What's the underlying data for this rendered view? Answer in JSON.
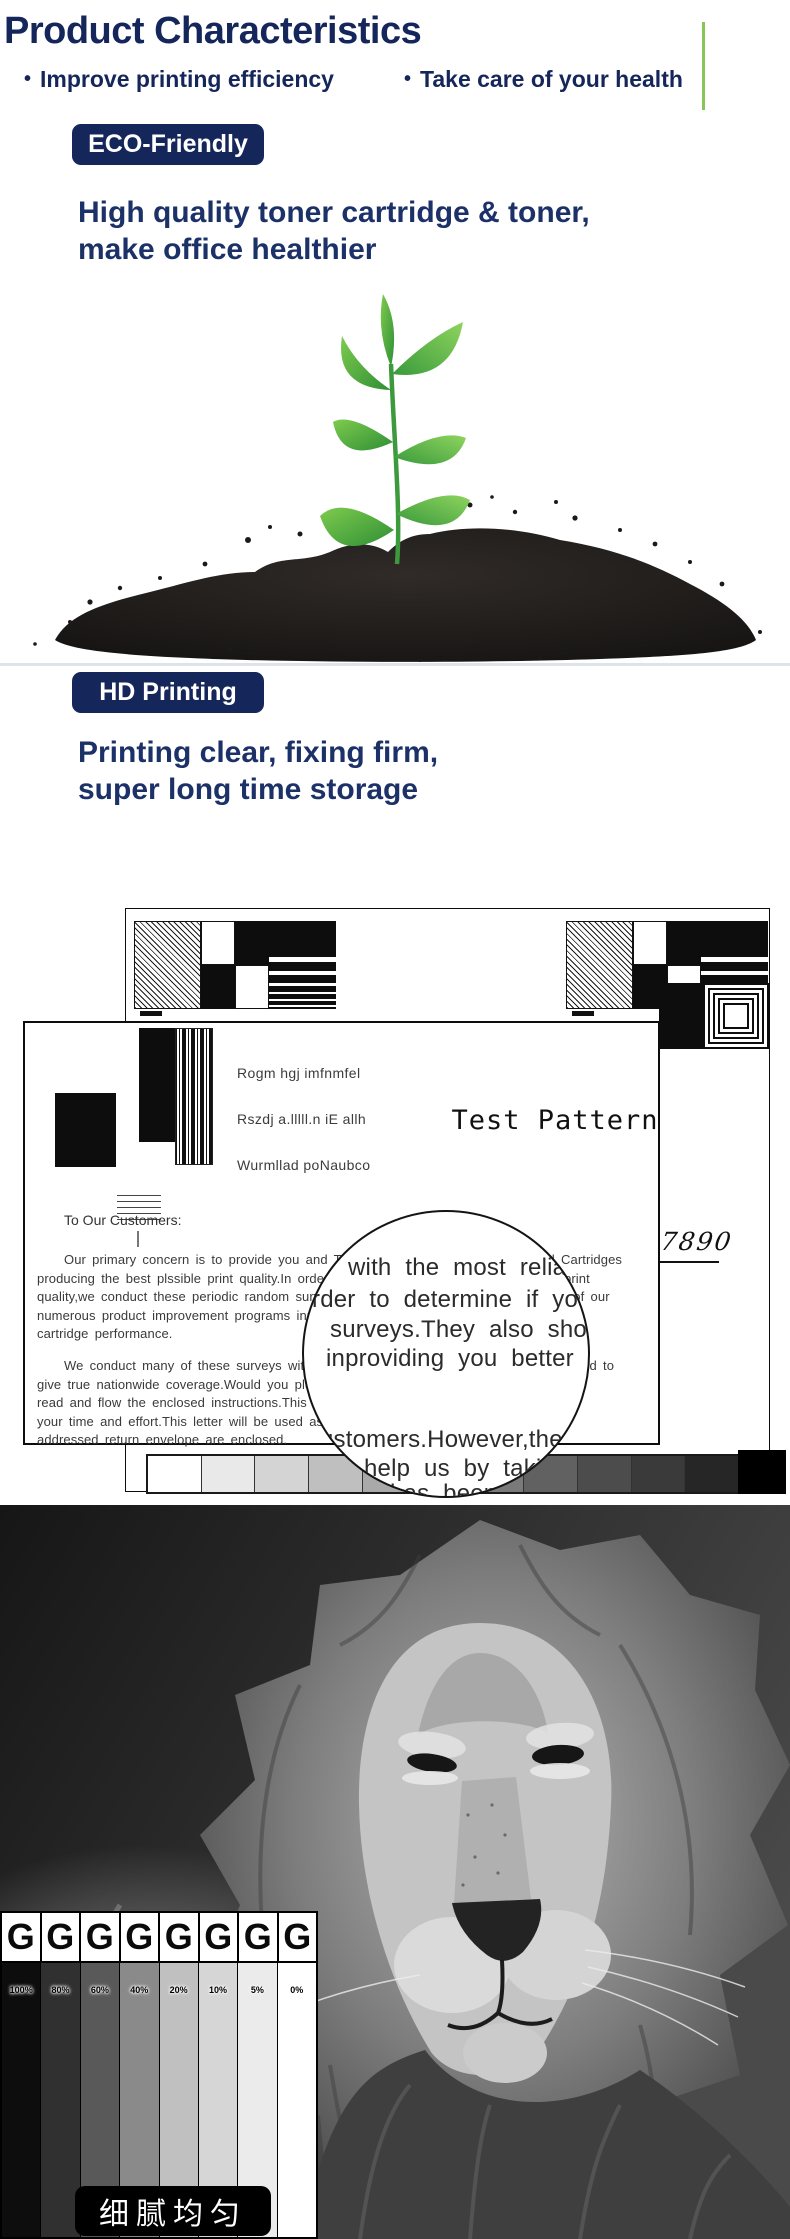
{
  "page": {
    "title": "Product Characteristics",
    "bullet1": "Improve printing efficiency",
    "bullet2": "Take care of your health",
    "bullet_dot": "•",
    "accent_navy": "#15265a",
    "accent_green": "#86c556"
  },
  "eco_section": {
    "badge": "ECO-Friendly",
    "headline_line1": "High quality toner cartridge & toner,",
    "headline_line2": "make office healthier"
  },
  "hd_section": {
    "badge": "HD Printing",
    "headline_line1": "Printing clear, fixing firm,",
    "headline_line2": "super long time storage"
  },
  "test_pattern": {
    "title": "Test Pattern",
    "sample_line1": "Rogm hgj imfnmfel",
    "sample_line2": "Rszdj a.lllll.n iE allh",
    "sample_line3": "Wurmllad poNaubco",
    "salutation": "To Our Customers:",
    "paragraph1": [
      "Our primary concern is to provide you and Toner with the most reliable Imaged Cartridges",
      "producing the best plssible print quality.In order to determine if you are getting good print",
      "quality,we conduct these periodic random surveys.They also shou us the effectiveness of our",
      "numerous product improvement programs inproviding you better remarks to deliver toner",
      "cartridge performance."
    ],
    "paragraph2": [
      "We conduct many of these surveys with customers.However,these surveys are needed to",
      "give true nationwide coverage.Would you please help us by taking a little time to",
      "read and flow the enclosed instructions.This survey has been taking a minimum of",
      "your time and effort.This letter will be used as a prepaid postage and self",
      "addressed return envelope are enclosed."
    ],
    "magnifier_lines": [
      "with the most reliable",
      "rder to determine if you are",
      "surveys.They also shou us th",
      "inproviding you better rema",
      "ustomers.However,these",
      "help us by taking a",
      "has been"
    ],
    "handwriting": "7890",
    "grayscale_steps": [
      "#ffffff",
      "#e9e9e9",
      "#d4d4d4",
      "#bfbfbf",
      "#a9a9a9",
      "#949494",
      "#7a7a7a",
      "#616161",
      "#4c4c4c",
      "#3a3a3a",
      "#262626",
      "#000000"
    ]
  },
  "density_chart": {
    "type": "table",
    "letter": "G",
    "columns": [
      {
        "label": "100%",
        "color": "#0d0d0d"
      },
      {
        "label": "80%",
        "color": "#303030"
      },
      {
        "label": "60%",
        "color": "#595959"
      },
      {
        "label": "40%",
        "color": "#8a8a8a"
      },
      {
        "label": "20%",
        "color": "#c0c0c0"
      },
      {
        "label": "10%",
        "color": "#d6d6d6"
      },
      {
        "label": "5%",
        "color": "#ebebeb"
      },
      {
        "label": "0%",
        "color": "#ffffff"
      }
    ],
    "caption": "细腻均匀"
  }
}
